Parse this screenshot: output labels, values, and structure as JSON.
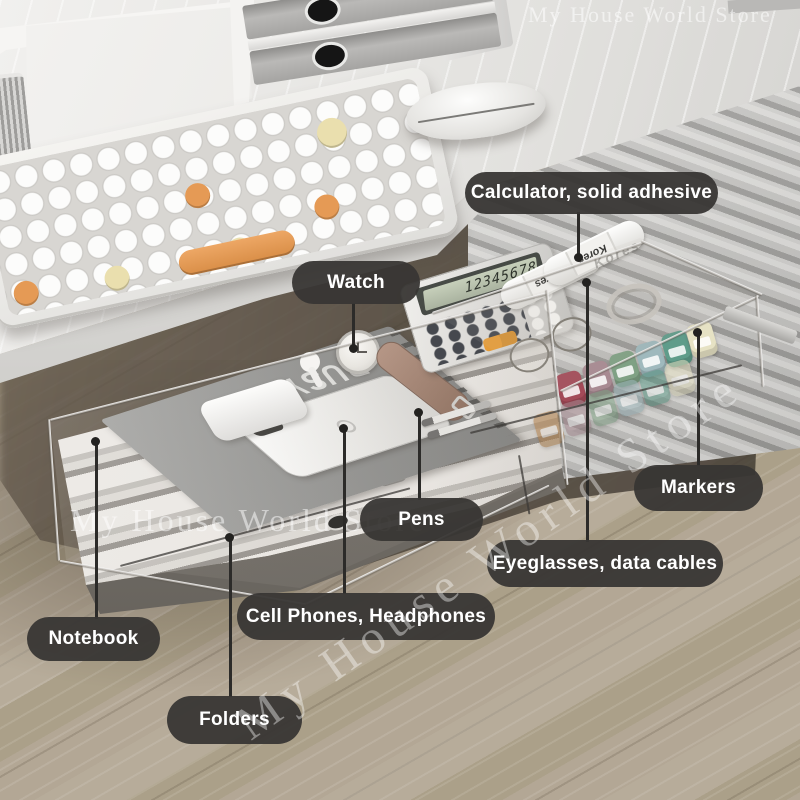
{
  "callouts": {
    "calculator": "Calculator, solid adhesive",
    "watch": "Watch",
    "pens": "Pens",
    "markers": "Markers",
    "eyeglasses": "Eyeglasses, data cables",
    "cell_phones": "Cell Phones, Headphones",
    "notebook": "Notebook",
    "folders": "Folders"
  },
  "scene": {
    "notebook_cover_text": "I'M VERY BUSY",
    "calculator_display": "12345678",
    "glue_stick_brand": "Kores"
  },
  "watermark": {
    "text": "My House World Store"
  },
  "colors": {
    "callout_background": "#383634",
    "callout_text": "#ffffff",
    "keyboard_accent_orange": "#e59a55",
    "keyboard_accent_cream": "#eadfae",
    "marker_caps": [
      "#a34a58",
      "#a88a92",
      "#7fa184",
      "#9fb9bd",
      "#5f9c8a",
      "#e6e2c4"
    ]
  }
}
